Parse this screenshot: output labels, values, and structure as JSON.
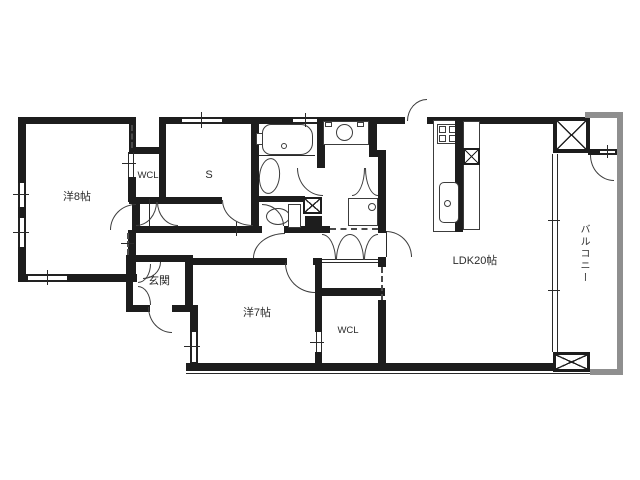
{
  "floorplan": {
    "title": "apartment-floor-plan",
    "rooms": {
      "bedroom8": {
        "label": "洋8帖"
      },
      "wcl_north": {
        "label": "WCL"
      },
      "service_room": {
        "label": "S"
      },
      "entrance": {
        "label": "玄関"
      },
      "bedroom7": {
        "label": "洋7帖"
      },
      "wcl_south": {
        "label": "WCL"
      },
      "ldk": {
        "label": "LDK20帖"
      },
      "balcony": {
        "label": "バルコニー"
      }
    },
    "colors": {
      "wall": "#1d1d1d",
      "balcony_rail": "#8f8f8f",
      "background": "#ffffff",
      "fixture_line": "#3c3c3c",
      "label_text": "#2b2b2b"
    }
  }
}
